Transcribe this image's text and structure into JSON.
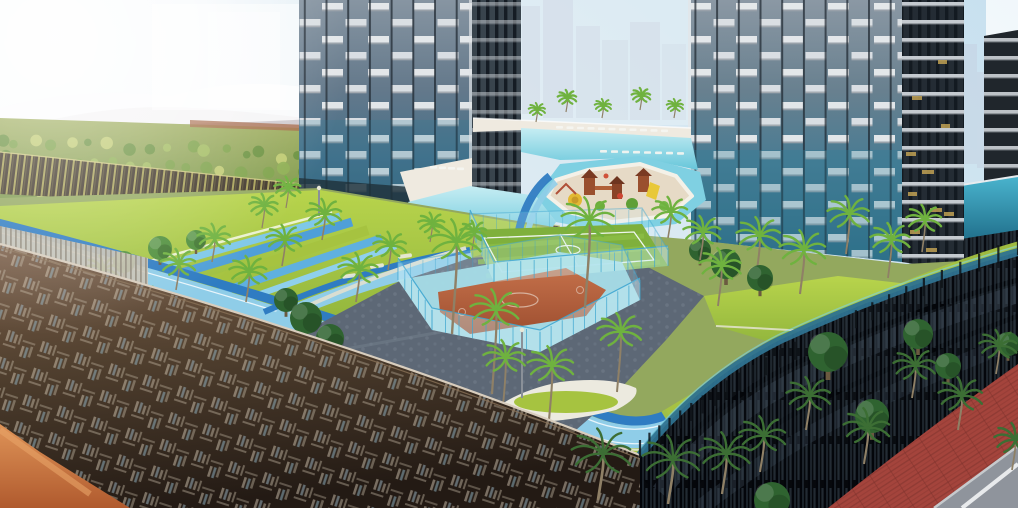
{
  "meta": {
    "scene_type": "architectural-rendering",
    "visible_text": "none",
    "description": "Aerial render of residential towers with rooftop amenity deck: running track, sports courts, lagoon pool, playground, palm landscaping, bronze perforated podium screen and dark louvered podium over a street."
  },
  "palette": {
    "sky_top": "#c7e0ef",
    "sky_low": "#f0f4f6",
    "sun": "#ffffff",
    "hill": "#b3a4a8",
    "cloud": "#fbfcfd",
    "orchard_hi": "#a3b163",
    "orchard_lo": "#6e8f45",
    "earth": "#a86a4a",
    "ghost": "#ffffff",
    "skyline": "#c3cedd",
    "haze": "#e9f1f6",
    "glass_top_l": "#8795a2",
    "glass_teal_l": "#336178",
    "glass_top_r": "#8b98a4",
    "glass_teal_r": "#2e6b84",
    "band_white": "#e9ecee",
    "mullion": "#1c252d",
    "side_dark_l": "#39444d",
    "side_dark_r": "#242c34",
    "slab": "#ced3d8",
    "gold": "#c9a855",
    "wall_dark": "#3f352a",
    "wall_slat": "#d8d26a",
    "fence_light": "#c9c2b4",
    "deck_base": "#93a85e",
    "lawn_hi": "#b8d44c",
    "lawn_lo": "#90b43c",
    "lawn_band": "#a6c340",
    "canal_blue": "#4f9fd8",
    "canal_light": "#7fc8e8",
    "canal_white": "#ffffff",
    "paving": "#5d6876",
    "track_light": "#8fcde8",
    "track_dark": "#2f7cc2",
    "lane_white": "#ffffff",
    "court_green": "#7fb03c",
    "court_stripe": "#8cbe46",
    "court_line": "#eef6ee",
    "court_orange_hi": "#c4704a",
    "court_orange_lo": "#9e4f30",
    "court_apron": "#a6dde8",
    "fence_glass": "#cdeef8",
    "fence_post": "#3fa6d0",
    "beach": "#efeae0",
    "pool_hi": "#c6edf3",
    "pool_lo": "#66c6da",
    "river": "#7fd0e2",
    "island": "#e6dac6",
    "island_rim": "#f4f1e8",
    "play_brown": "#9a4f2e",
    "play_brown2": "#8a4428",
    "play_roof": "#7a3a22",
    "play_yellow": "#e8c838",
    "play_green": "#6cae3c",
    "play_red": "#cc4633",
    "palm_light": "#6fb23f",
    "palm_dark": "#3c6e34",
    "palm_trunk": "#8f8066",
    "tree_green": "#4f8f3c",
    "tree_dark": "#2f6330",
    "bronze_hi": "#7e624c",
    "bronze_mid": "#51402f",
    "bronze_lo": "#231a14",
    "screen_edge": "#d8cdbd",
    "terracotta_hi": "#df9458",
    "terracotta_lo": "#b05a2e",
    "podium_dark": "#10151b",
    "podium_glass_row": "#36424e",
    "balustrade": "#2e7290",
    "balustrade_hi": "#7fd4e4",
    "poolglass_hi": "#4ab4ce",
    "poolglass_lo": "#1d6a86",
    "striped_dark": "#20262c",
    "sidewalk": "#a4443c",
    "road": "#8f949c",
    "road_line": "#e8eaec",
    "curb": "#c6cacd",
    "lounger": "#f5f5f1",
    "pole": "#8a9098",
    "planter_white": "#eceadf"
  },
  "scene": {
    "ghost_blocks": [
      [
        152,
        4,
        186,
        106,
        0.5
      ],
      [
        208,
        12,
        72,
        96,
        0.35
      ],
      [
        986,
        0,
        32,
        58,
        0.75
      ]
    ],
    "skyline_bars": [
      [
        522,
        6,
        18,
        108,
        0.7
      ],
      [
        543,
        0,
        30,
        118,
        0.75
      ],
      [
        576,
        26,
        24,
        92,
        0.6
      ],
      [
        602,
        40,
        26,
        80,
        0.55
      ],
      [
        630,
        22,
        30,
        98,
        0.65
      ],
      [
        662,
        44,
        24,
        76,
        0.5
      ],
      [
        964,
        44,
        13,
        120,
        0.45
      ],
      [
        977,
        72,
        15,
        96,
        0.4
      ]
    ],
    "orchard": {
      "rows": [
        [
          0,
          140,
          468,
          166,
          26,
          3.5,
          6.5
        ],
        [
          0,
          160,
          468,
          180,
          26,
          4,
          7
        ],
        [
          0,
          180,
          468,
          198,
          24,
          4.5,
          8
        ],
        [
          0,
          202,
          468,
          214,
          22,
          5,
          9
        ],
        [
          0,
          224,
          460,
          228,
          18,
          5,
          9
        ]
      ],
      "tones": [
        "#7da24a",
        "#8fb054",
        "#6a9140",
        "#a3bd62",
        "#c2cc74"
      ],
      "seed": 13
    },
    "lounger_rows": [
      {
        "x": 556,
        "y": 126,
        "n": 11,
        "dx": 10.5,
        "dy": 0.35
      },
      {
        "x": 600,
        "y": 150,
        "n": 8,
        "dx": 11,
        "dy": 0.3
      },
      {
        "x": 430,
        "y": 166,
        "n": 4,
        "dx": 9,
        "dy": 0.5
      }
    ],
    "palms": [
      [
        100,
        296,
        30,
        26,
        "l",
        "deck"
      ],
      [
        138,
        330,
        34,
        30,
        "l",
        "deck"
      ],
      [
        176,
        290,
        32,
        26,
        "l",
        "deck"
      ],
      [
        212,
        262,
        30,
        24,
        "l",
        "deck"
      ],
      [
        246,
        302,
        34,
        30,
        "l",
        "deck"
      ],
      [
        282,
        266,
        32,
        26,
        "l",
        "deck"
      ],
      [
        322,
        240,
        32,
        26,
        "l",
        "deck"
      ],
      [
        356,
        302,
        36,
        32,
        "l",
        "deck"
      ],
      [
        388,
        270,
        30,
        24,
        "l",
        "deck"
      ],
      [
        430,
        242,
        24,
        18,
        "l",
        "deck"
      ],
      [
        472,
        250,
        24,
        18,
        "l",
        "deck"
      ],
      [
        452,
        334,
        48,
        92,
        "l",
        "deck"
      ],
      [
        492,
        394,
        44,
        84,
        "l",
        "deck"
      ],
      [
        585,
        308,
        48,
        88,
        "l",
        "deck"
      ],
      [
        502,
        418,
        38,
        60,
        "l",
        "deck"
      ],
      [
        548,
        432,
        42,
        66,
        "l",
        "deck"
      ],
      [
        617,
        392,
        40,
        60,
        "l",
        "deck"
      ],
      [
        668,
        238,
        32,
        26,
        "l",
        "deck"
      ],
      [
        700,
        260,
        34,
        28,
        "l",
        "deck"
      ],
      [
        718,
        306,
        38,
        40,
        "l",
        "deck"
      ],
      [
        756,
        278,
        40,
        42,
        "l",
        "deck"
      ],
      [
        800,
        294,
        42,
        44,
        "l",
        "deck"
      ],
      [
        846,
        254,
        38,
        40,
        "l",
        "deck"
      ],
      [
        888,
        278,
        36,
        38,
        "l",
        "deck"
      ],
      [
        922,
        252,
        32,
        32,
        "l",
        "deck"
      ],
      [
        286,
        208,
        24,
        20,
        "l",
        "deck"
      ],
      [
        262,
        228,
        26,
        22,
        "l",
        "deck"
      ],
      [
        536,
        122,
        15,
        12,
        "l",
        "deck"
      ],
      [
        566,
        112,
        17,
        14,
        "l",
        "deck"
      ],
      [
        602,
        118,
        15,
        12,
        "l",
        "deck"
      ],
      [
        640,
        110,
        17,
        14,
        "l",
        "deck"
      ],
      [
        674,
        118,
        15,
        12,
        "l",
        "deck"
      ],
      [
        598,
        500,
        54,
        46,
        "d",
        "street"
      ],
      [
        668,
        504,
        52,
        44,
        "d",
        "street"
      ],
      [
        722,
        494,
        46,
        40,
        "d",
        "street"
      ],
      [
        760,
        472,
        42,
        36,
        "d",
        "street"
      ],
      [
        806,
        430,
        40,
        34,
        "d",
        "street"
      ],
      [
        864,
        464,
        42,
        36,
        "d",
        "street"
      ],
      [
        912,
        398,
        38,
        32,
        "d",
        "street"
      ],
      [
        958,
        430,
        40,
        34,
        "d",
        "street"
      ],
      [
        996,
        374,
        34,
        28,
        "d",
        "street"
      ],
      [
        1012,
        470,
        36,
        30,
        "d",
        "street"
      ]
    ],
    "trees": [
      [
        306,
        318,
        16,
        "d",
        "deck"
      ],
      [
        330,
        338,
        14,
        "d",
        "deck"
      ],
      [
        286,
        300,
        12,
        "d",
        "deck"
      ],
      [
        726,
        264,
        15,
        "d",
        "deck"
      ],
      [
        760,
        278,
        13,
        "d",
        "deck"
      ],
      [
        700,
        250,
        11,
        "d",
        "deck"
      ],
      [
        160,
        248,
        12,
        "m",
        "deck"
      ],
      [
        124,
        262,
        11,
        "m",
        "deck"
      ],
      [
        196,
        240,
        10,
        "m",
        "deck"
      ],
      [
        828,
        352,
        20,
        "d",
        "street"
      ],
      [
        918,
        334,
        15,
        "d",
        "street"
      ],
      [
        872,
        416,
        17,
        "d",
        "street"
      ],
      [
        772,
        500,
        18,
        "d",
        "street"
      ],
      [
        948,
        366,
        13,
        "d",
        "street"
      ],
      [
        1008,
        344,
        12,
        "d",
        "street"
      ]
    ],
    "fences": [
      {
        "name": "futsal-court-fence-front",
        "h": 20,
        "o": 1,
        "points": [
          [
            470,
            230
          ],
          [
            494,
            282
          ],
          [
            668,
            266
          ]
        ]
      },
      {
        "name": "futsal-court-fence-back",
        "h": 16,
        "o": 0.5,
        "points": [
          [
            470,
            230
          ],
          [
            642,
            224
          ],
          [
            668,
            266
          ]
        ]
      },
      {
        "name": "basketball-court-fence-front",
        "h": 22,
        "o": 1,
        "points": [
          [
            398,
            280
          ],
          [
            432,
            330
          ],
          [
            540,
            352
          ],
          [
            640,
            300
          ]
        ]
      },
      {
        "name": "basketball-court-fence-back",
        "h": 17,
        "o": 0.55,
        "points": [
          [
            398,
            280
          ],
          [
            560,
            252
          ],
          [
            622,
            262
          ],
          [
            640,
            300
          ]
        ]
      }
    ],
    "poles": [
      [
        522,
        398,
        522,
        330
      ],
      [
        319,
        216,
        319,
        188
      ]
    ],
    "gold_glints": [
      [
        906,
        152,
        10,
        4
      ],
      [
        922,
        170,
        12,
        4
      ],
      [
        908,
        192,
        9,
        4
      ],
      [
        930,
        208,
        12,
        4
      ],
      [
        910,
        230,
        10,
        4
      ],
      [
        926,
        248,
        11,
        4
      ],
      [
        941,
        124,
        9,
        4
      ],
      [
        944,
        212,
        10,
        4
      ],
      [
        938,
        60,
        9,
        4
      ],
      [
        912,
        96,
        10,
        4
      ]
    ],
    "edge_railing": {
      "p0": [
        640,
        455
      ],
      "p1": [
        760,
        360
      ],
      "p2": [
        1018,
        252
      ],
      "step": 26,
      "slat_h": 15
    }
  }
}
